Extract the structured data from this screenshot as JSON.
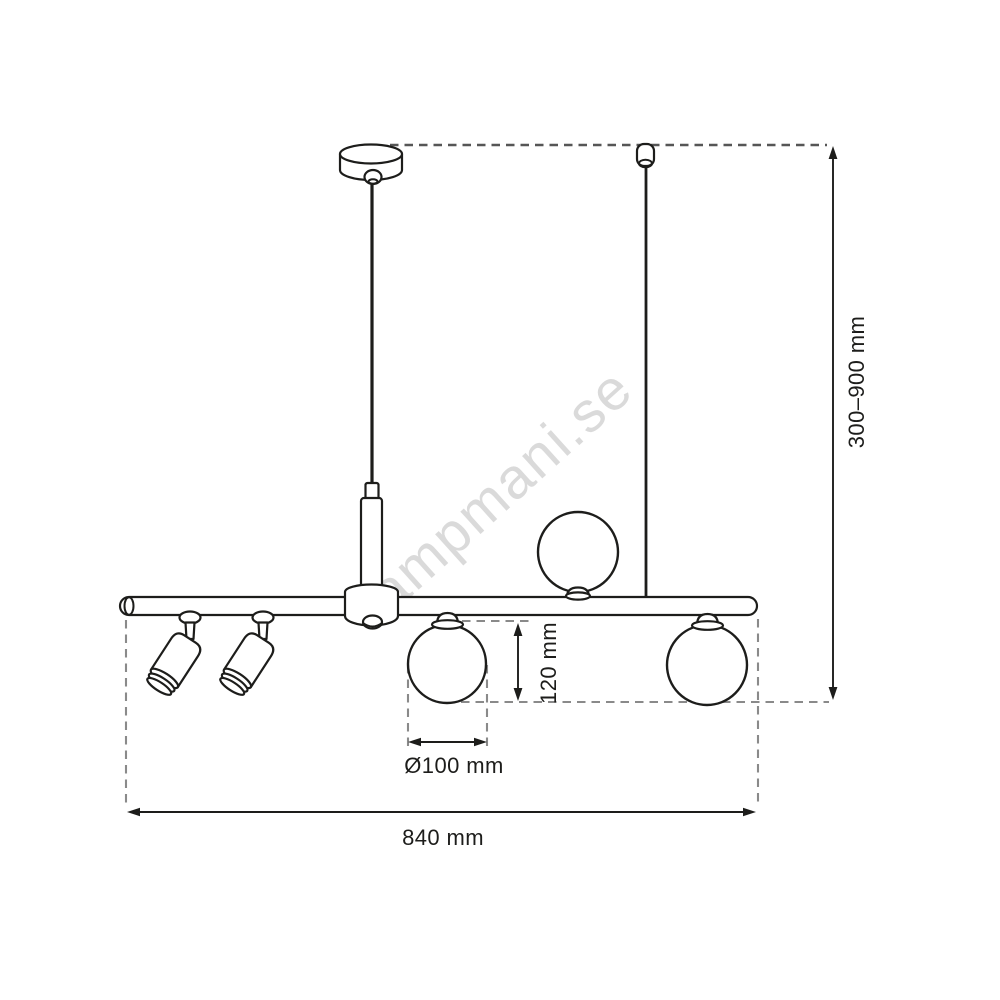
{
  "watermark": {
    "text": "lampmani.se"
  },
  "dimensions": {
    "suspension_height": {
      "label": "300–900 mm"
    },
    "fixture_width": {
      "label": "840 mm"
    },
    "globe_drop": {
      "label": "120 mm"
    },
    "globe_diameter": {
      "label": "Ø100 mm"
    }
  },
  "colors": {
    "line": "#1d1d1b",
    "dash": "#8a8a8a",
    "dashdark": "#565656",
    "watermark": "#c4c4c4",
    "bg": "#ffffff"
  }
}
